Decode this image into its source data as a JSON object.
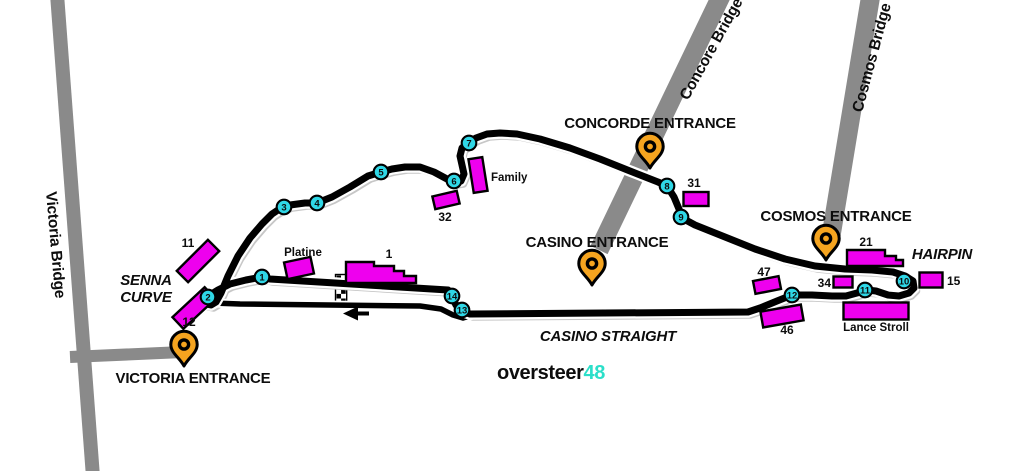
{
  "canvas": {
    "width": 1024,
    "height": 471,
    "background": "#ffffff"
  },
  "colors": {
    "track": "#000000",
    "track_casing": "#ffffff",
    "track_shadow": "#c7c7c7",
    "road": "#8a8a8a",
    "stand_fill": "#ee00ee",
    "stand_border": "#000000",
    "turn_fill": "#2fd7e6",
    "turn_border": "#000000",
    "pin_fill": "#f5a41f",
    "pin_border": "#000000",
    "logo_accent": "#2bdfc9",
    "text": "#0d0d0d"
  },
  "logo": {
    "word": "oversteer",
    "number": "48",
    "x": 497,
    "y": 379
  },
  "bridges": [
    {
      "id": "victoria",
      "label": "Victoria Bridge",
      "x1": 57,
      "y1": -6,
      "x2": 93,
      "y2": 477,
      "width": 14,
      "label_x": 46,
      "label_y": 192,
      "label_rotate": 85
    },
    {
      "id": "victoria-access",
      "label": "",
      "x1": 70,
      "y1": 357,
      "x2": 183,
      "y2": 352,
      "width": 12
    },
    {
      "id": "concore",
      "label": "Concore Bridge",
      "x1": 722,
      "y1": -6,
      "x2": 599,
      "y2": 250,
      "width": 19,
      "label_x": 688,
      "label_y": 101,
      "label_rotate": -61
    },
    {
      "id": "cosmos",
      "label": "Cosmos Bridge",
      "x1": 871,
      "y1": -6,
      "x2": 831,
      "y2": 236,
      "width": 19,
      "label_x": 862,
      "label_y": 113,
      "label_rotate": -75
    }
  ],
  "track": {
    "main_d": "M448,290 L270,279 L262,277 L246,280 L230,284 L218,290 L210,295 L205,300 L206,304 L211,305 L216,302 L221,293 L228,276 L238,256 L250,238 L262,224 L272,214 L281,208 L290,205 L305,203 L317,203 L332,197 L350,187 L368,176 L381,172 L392,169 L405,167 L420,167 L434,172 L447,179 L454,182 L461,181 L464,174 L462,165 L460,156 L462,148 L468,143 L476,138 L487,134 L500,133 L517,134 L540,139 L570,148 L600,159 L630,171 L658,182 L667,186 L674,197 L679,209 L682,218 L695,225 L725,237 L755,249 L785,259 L815,266 L845,269 L872,270 L893,272 L905,276 L913,281 L914,288 L909,293 L899,296 L888,295 L876,291 L867,290 L857,293 L846,296 L832,296 L812,295 L792,295 L777,301 L760,308 L748,312 L470,314 L461,311 L456,305 L452,297 L449,292 Z",
    "pit_d": "M213,303 L240,304 L420,306 L441,309 L453,315 L463,318 L473,315",
    "width": 7,
    "casing_width": 11.5,
    "pit_width": 5.5,
    "pit_casing_width": 9
  },
  "start_finish": {
    "x": 336.5,
    "y": 275.5,
    "cols": 2,
    "rows": 7,
    "cell": 4.6
  },
  "direction_arrow": {
    "shaft": [
      369,
      313.5,
      355,
      313.5
    ],
    "head": [
      [
        343,
        313.5
      ],
      [
        358,
        306.5
      ],
      [
        358,
        320.5
      ]
    ]
  },
  "turns": [
    {
      "n": "1",
      "x": 262,
      "y": 277
    },
    {
      "n": "2",
      "x": 208,
      "y": 297
    },
    {
      "n": "3",
      "x": 284,
      "y": 207
    },
    {
      "n": "4",
      "x": 317,
      "y": 203
    },
    {
      "n": "5",
      "x": 381,
      "y": 172
    },
    {
      "n": "6",
      "x": 454,
      "y": 181
    },
    {
      "n": "7",
      "x": 469,
      "y": 143
    },
    {
      "n": "8",
      "x": 667,
      "y": 186
    },
    {
      "n": "9",
      "x": 681,
      "y": 217
    },
    {
      "n": "10",
      "x": 904,
      "y": 281
    },
    {
      "n": "11",
      "x": 865,
      "y": 290
    },
    {
      "n": "12",
      "x": 792,
      "y": 295
    },
    {
      "n": "13",
      "x": 462,
      "y": 310
    },
    {
      "n": "14",
      "x": 452,
      "y": 296
    }
  ],
  "stands": [
    {
      "id": "11",
      "label": "11",
      "shape": "rect",
      "cx": 198,
      "cy": 261,
      "w": 44,
      "h": 16,
      "rot": -45,
      "lx": 188,
      "ly": 247,
      "anchor": "middle",
      "lsize": "num"
    },
    {
      "id": "12",
      "label": "12",
      "shape": "rect",
      "cx": 194,
      "cy": 308,
      "w": 44,
      "h": 16,
      "rot": -43,
      "lx": 189,
      "ly": 326,
      "anchor": "middle",
      "lsize": "num"
    },
    {
      "id": "platine",
      "label": "Platine",
      "shape": "rect",
      "cx": 299,
      "cy": 268,
      "w": 27,
      "h": 17,
      "rot": -12,
      "lx": 303,
      "ly": 256,
      "anchor": "middle",
      "lsize": "small"
    },
    {
      "id": "1",
      "label": "1",
      "shape": "poly",
      "points": [
        [
          346,
          262
        ],
        [
          374,
          262
        ],
        [
          374,
          266
        ],
        [
          394,
          266
        ],
        [
          394,
          271
        ],
        [
          404,
          271
        ],
        [
          404,
          276
        ],
        [
          416,
          276
        ],
        [
          416,
          283
        ],
        [
          346,
          283
        ]
      ],
      "lx": 389,
      "ly": 258,
      "anchor": "middle",
      "lsize": "num"
    },
    {
      "id": "32",
      "label": "32",
      "shape": "rect",
      "cx": 446,
      "cy": 200,
      "w": 25,
      "h": 13,
      "rot": -13,
      "lx": 445,
      "ly": 221,
      "anchor": "middle",
      "lsize": "num"
    },
    {
      "id": "family",
      "label": "Family",
      "shape": "rect",
      "cx": 478,
      "cy": 175,
      "w": 14,
      "h": 34,
      "rot": -9,
      "lx": 491,
      "ly": 181,
      "anchor": "start",
      "lsize": "small"
    },
    {
      "id": "31",
      "label": "31",
      "shape": "rect",
      "cx": 696,
      "cy": 199,
      "w": 25,
      "h": 14,
      "rot": 0,
      "lx": 694,
      "ly": 187,
      "anchor": "middle",
      "lsize": "num"
    },
    {
      "id": "47",
      "label": "47",
      "shape": "rect",
      "cx": 767,
      "cy": 285,
      "w": 26,
      "h": 13,
      "rot": -11,
      "lx": 764,
      "ly": 276,
      "anchor": "middle",
      "lsize": "num"
    },
    {
      "id": "46",
      "label": "46",
      "shape": "rect",
      "cx": 782,
      "cy": 316,
      "w": 41,
      "h": 16,
      "rot": -10,
      "lx": 787,
      "ly": 334,
      "anchor": "middle",
      "lsize": "num"
    },
    {
      "id": "34",
      "label": "34",
      "shape": "rect",
      "cx": 843,
      "cy": 282,
      "w": 19,
      "h": 11,
      "rot": 0,
      "lx": 831,
      "ly": 287,
      "anchor": "end",
      "lsize": "num"
    },
    {
      "id": "21",
      "label": "21",
      "shape": "poly",
      "points": [
        [
          847,
          250
        ],
        [
          885,
          250
        ],
        [
          885,
          256
        ],
        [
          896,
          256
        ],
        [
          896,
          260
        ],
        [
          903,
          260
        ],
        [
          903,
          266
        ],
        [
          847,
          266
        ]
      ],
      "lx": 866,
      "ly": 246,
      "anchor": "middle",
      "lsize": "num"
    },
    {
      "id": "15",
      "label": "15",
      "shape": "rect",
      "cx": 931,
      "cy": 280,
      "w": 23,
      "h": 15,
      "rot": 0,
      "lx": 947,
      "ly": 285,
      "anchor": "start",
      "lsize": "num"
    },
    {
      "id": "lance-stroll",
      "label": "Lance Stroll",
      "shape": "rect",
      "cx": 876,
      "cy": 311,
      "w": 65,
      "h": 17,
      "rot": 0,
      "lx": 876,
      "ly": 331,
      "anchor": "middle",
      "lsize": "small"
    }
  ],
  "entrances": [
    {
      "id": "victoria",
      "label": "VICTORIA ENTRANCE",
      "tip_x": 184,
      "tip_y": 366,
      "label_x": 193,
      "label_y": 383
    },
    {
      "id": "concorde",
      "label": "CONCORDE ENTRANCE",
      "tip_x": 650,
      "tip_y": 168,
      "label_x": 650,
      "label_y": 128
    },
    {
      "id": "casino",
      "label": "CASINO ENTRANCE",
      "tip_x": 592,
      "tip_y": 285,
      "label_x": 597,
      "label_y": 247
    },
    {
      "id": "cosmos",
      "label": "COSMOS ENTRANCE",
      "tip_x": 826,
      "tip_y": 260,
      "label_x": 836,
      "label_y": 221
    }
  ],
  "corner_labels": [
    {
      "id": "senna-curve",
      "lines": [
        "SENNA",
        "CURVE"
      ],
      "x": 146,
      "y": 285,
      "line_h": 17
    },
    {
      "id": "casino-straight",
      "lines": [
        "CASINO STRAIGHT"
      ],
      "x": 608,
      "y": 341,
      "line_h": 17
    },
    {
      "id": "hairpin",
      "lines": [
        "HAIRPIN"
      ],
      "x": 942,
      "y": 259,
      "line_h": 17
    }
  ]
}
